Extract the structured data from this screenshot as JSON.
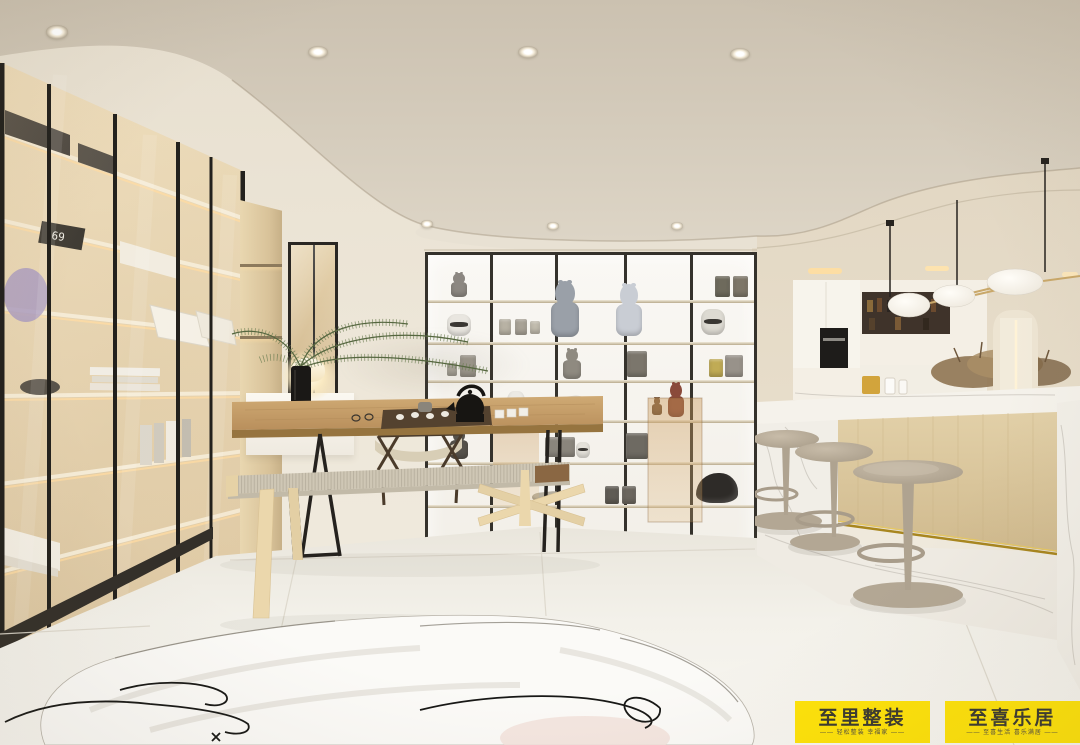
{
  "badges": {
    "left": {
      "title": "至里整装",
      "subtitle": "—— 轻松整装 幸福家 ——"
    },
    "right": {
      "title": "至喜乐居",
      "subtitle": "—— 至喜生活 喜乐满居 ——"
    }
  },
  "cabinet": {
    "clock_text": "69"
  },
  "palette": {
    "badge-bg": "#FFE30A",
    "badge-text": "#3B3A30",
    "ceiling": "#D3CABA",
    "wall": "#EBE4D6",
    "floor": "#F0EDE5",
    "frame-dark": "#33302B",
    "wood-light": "#E0C9A0",
    "wood-mid": "#C49E6C",
    "marble": "#F3F0E9",
    "stool": "#B6AA97",
    "brass": "#C7A566"
  },
  "lights": {
    "ceiling_spots": [
      {
        "x": 57,
        "y": 32,
        "r": 11
      },
      {
        "x": 318,
        "y": 52,
        "r": 10
      },
      {
        "x": 528,
        "y": 52,
        "r": 10
      },
      {
        "x": 740,
        "y": 54,
        "r": 10
      }
    ],
    "fascia_spots": [
      {
        "x": 427,
        "y": 224,
        "r": 6
      },
      {
        "x": 553,
        "y": 226,
        "r": 6
      },
      {
        "x": 677,
        "y": 226,
        "r": 6
      }
    ]
  },
  "figurines": [
    {
      "name": "figurine-mini",
      "x": 459,
      "y": 297,
      "w": 20,
      "h": 24,
      "c": "#8C8781",
      "t": "bear"
    },
    {
      "name": "figurine-bearbrick-grey",
      "x": 565,
      "y": 337,
      "w": 34,
      "h": 56,
      "c": "#9AA0A8",
      "t": "bear"
    },
    {
      "name": "figurine-bearbrick-clear",
      "x": 629,
      "y": 336,
      "w": 32,
      "h": 52,
      "c": "#C9CDD4",
      "t": "bear"
    },
    {
      "name": "figurine-funko-1",
      "x": 722,
      "y": 297,
      "w": 15,
      "h": 21,
      "c": "#6E6A5C",
      "t": "box"
    },
    {
      "name": "figurine-funko-2",
      "x": 740,
      "y": 297,
      "w": 15,
      "h": 21,
      "c": "#7D7668",
      "t": "box"
    },
    {
      "name": "figurine-trooper-helmet",
      "x": 459,
      "y": 336,
      "w": 24,
      "h": 22,
      "c": "#E9E6E0",
      "t": "helmet"
    },
    {
      "name": "figurine-mini-box-1",
      "x": 505,
      "y": 335,
      "w": 12,
      "h": 16,
      "c": "#B8B2A4",
      "t": "box"
    },
    {
      "name": "figurine-mini-box-2",
      "x": 521,
      "y": 335,
      "w": 12,
      "h": 16,
      "c": "#A8A296",
      "t": "box"
    },
    {
      "name": "figurine-mini-box-3",
      "x": 535,
      "y": 334,
      "w": 10,
      "h": 13,
      "c": "#C2BCAE",
      "t": "box"
    },
    {
      "name": "figurine-trooper",
      "x": 713,
      "y": 335,
      "w": 24,
      "h": 26,
      "c": "#DDDAD2",
      "t": "helmet"
    },
    {
      "name": "figurine-robot-small",
      "x": 468,
      "y": 377,
      "w": 16,
      "h": 22,
      "c": "#9B968C",
      "t": "box"
    },
    {
      "name": "figurine-robot-tiny",
      "x": 452,
      "y": 376,
      "w": 10,
      "h": 13,
      "c": "#AAA69C",
      "t": "box"
    },
    {
      "name": "figurine-lego",
      "x": 572,
      "y": 379,
      "w": 22,
      "h": 30,
      "c": "#8F8A80",
      "t": "bear"
    },
    {
      "name": "figurine-robot-grey",
      "x": 637,
      "y": 377,
      "w": 20,
      "h": 26,
      "c": "#7B766C",
      "t": "box"
    },
    {
      "name": "figurine-toy-yellow",
      "x": 716,
      "y": 377,
      "w": 14,
      "h": 18,
      "c": "#C0AB55",
      "t": "box"
    },
    {
      "name": "figurine-toy-grey",
      "x": 734,
      "y": 377,
      "w": 18,
      "h": 22,
      "c": "#98928A",
      "t": "box"
    },
    {
      "name": "figurine-astronaut",
      "x": 516,
      "y": 417,
      "w": 18,
      "h": 26,
      "c": "#ECEAE4",
      "t": "helmet"
    },
    {
      "name": "figurine-spaceship",
      "x": 563,
      "y": 412,
      "w": 48,
      "h": 15,
      "c": "#D6D3CB",
      "t": "ship"
    },
    {
      "name": "figurine-bearbrick-red",
      "x": 676,
      "y": 417,
      "w": 20,
      "h": 34,
      "c": "#8A4A3A",
      "t": "bear"
    },
    {
      "name": "figurine-bear-brown",
      "x": 657,
      "y": 415,
      "w": 12,
      "h": 18,
      "c": "#7A5A40",
      "t": "bear"
    },
    {
      "name": "figurine-dark",
      "x": 459,
      "y": 459,
      "w": 22,
      "h": 30,
      "c": "#55514A",
      "t": "bear"
    },
    {
      "name": "figurine-lego-head",
      "x": 560,
      "y": 457,
      "w": 30,
      "h": 20,
      "c": "#8A857C",
      "t": "box"
    },
    {
      "name": "figurine-helmet-white",
      "x": 583,
      "y": 458,
      "w": 14,
      "h": 16,
      "c": "#E5E2DA",
      "t": "helmet"
    },
    {
      "name": "figurine-robot-box",
      "x": 637,
      "y": 459,
      "w": 22,
      "h": 26,
      "c": "#6E6A62",
      "t": "box"
    },
    {
      "name": "figurine-funko-3",
      "x": 612,
      "y": 504,
      "w": 14,
      "h": 18,
      "c": "#5F5B54",
      "t": "box"
    },
    {
      "name": "figurine-funko-4",
      "x": 629,
      "y": 504,
      "w": 14,
      "h": 18,
      "c": "#6B665E",
      "t": "box"
    },
    {
      "name": "figurine-gorilla",
      "x": 717,
      "y": 503,
      "w": 42,
      "h": 30,
      "c": "#2E2B28",
      "t": "gorilla"
    },
    {
      "name": "figurine-cup-row",
      "x": 546,
      "y": 500,
      "w": 28,
      "h": 8,
      "c": "#B5AE9E",
      "t": "ship"
    }
  ]
}
